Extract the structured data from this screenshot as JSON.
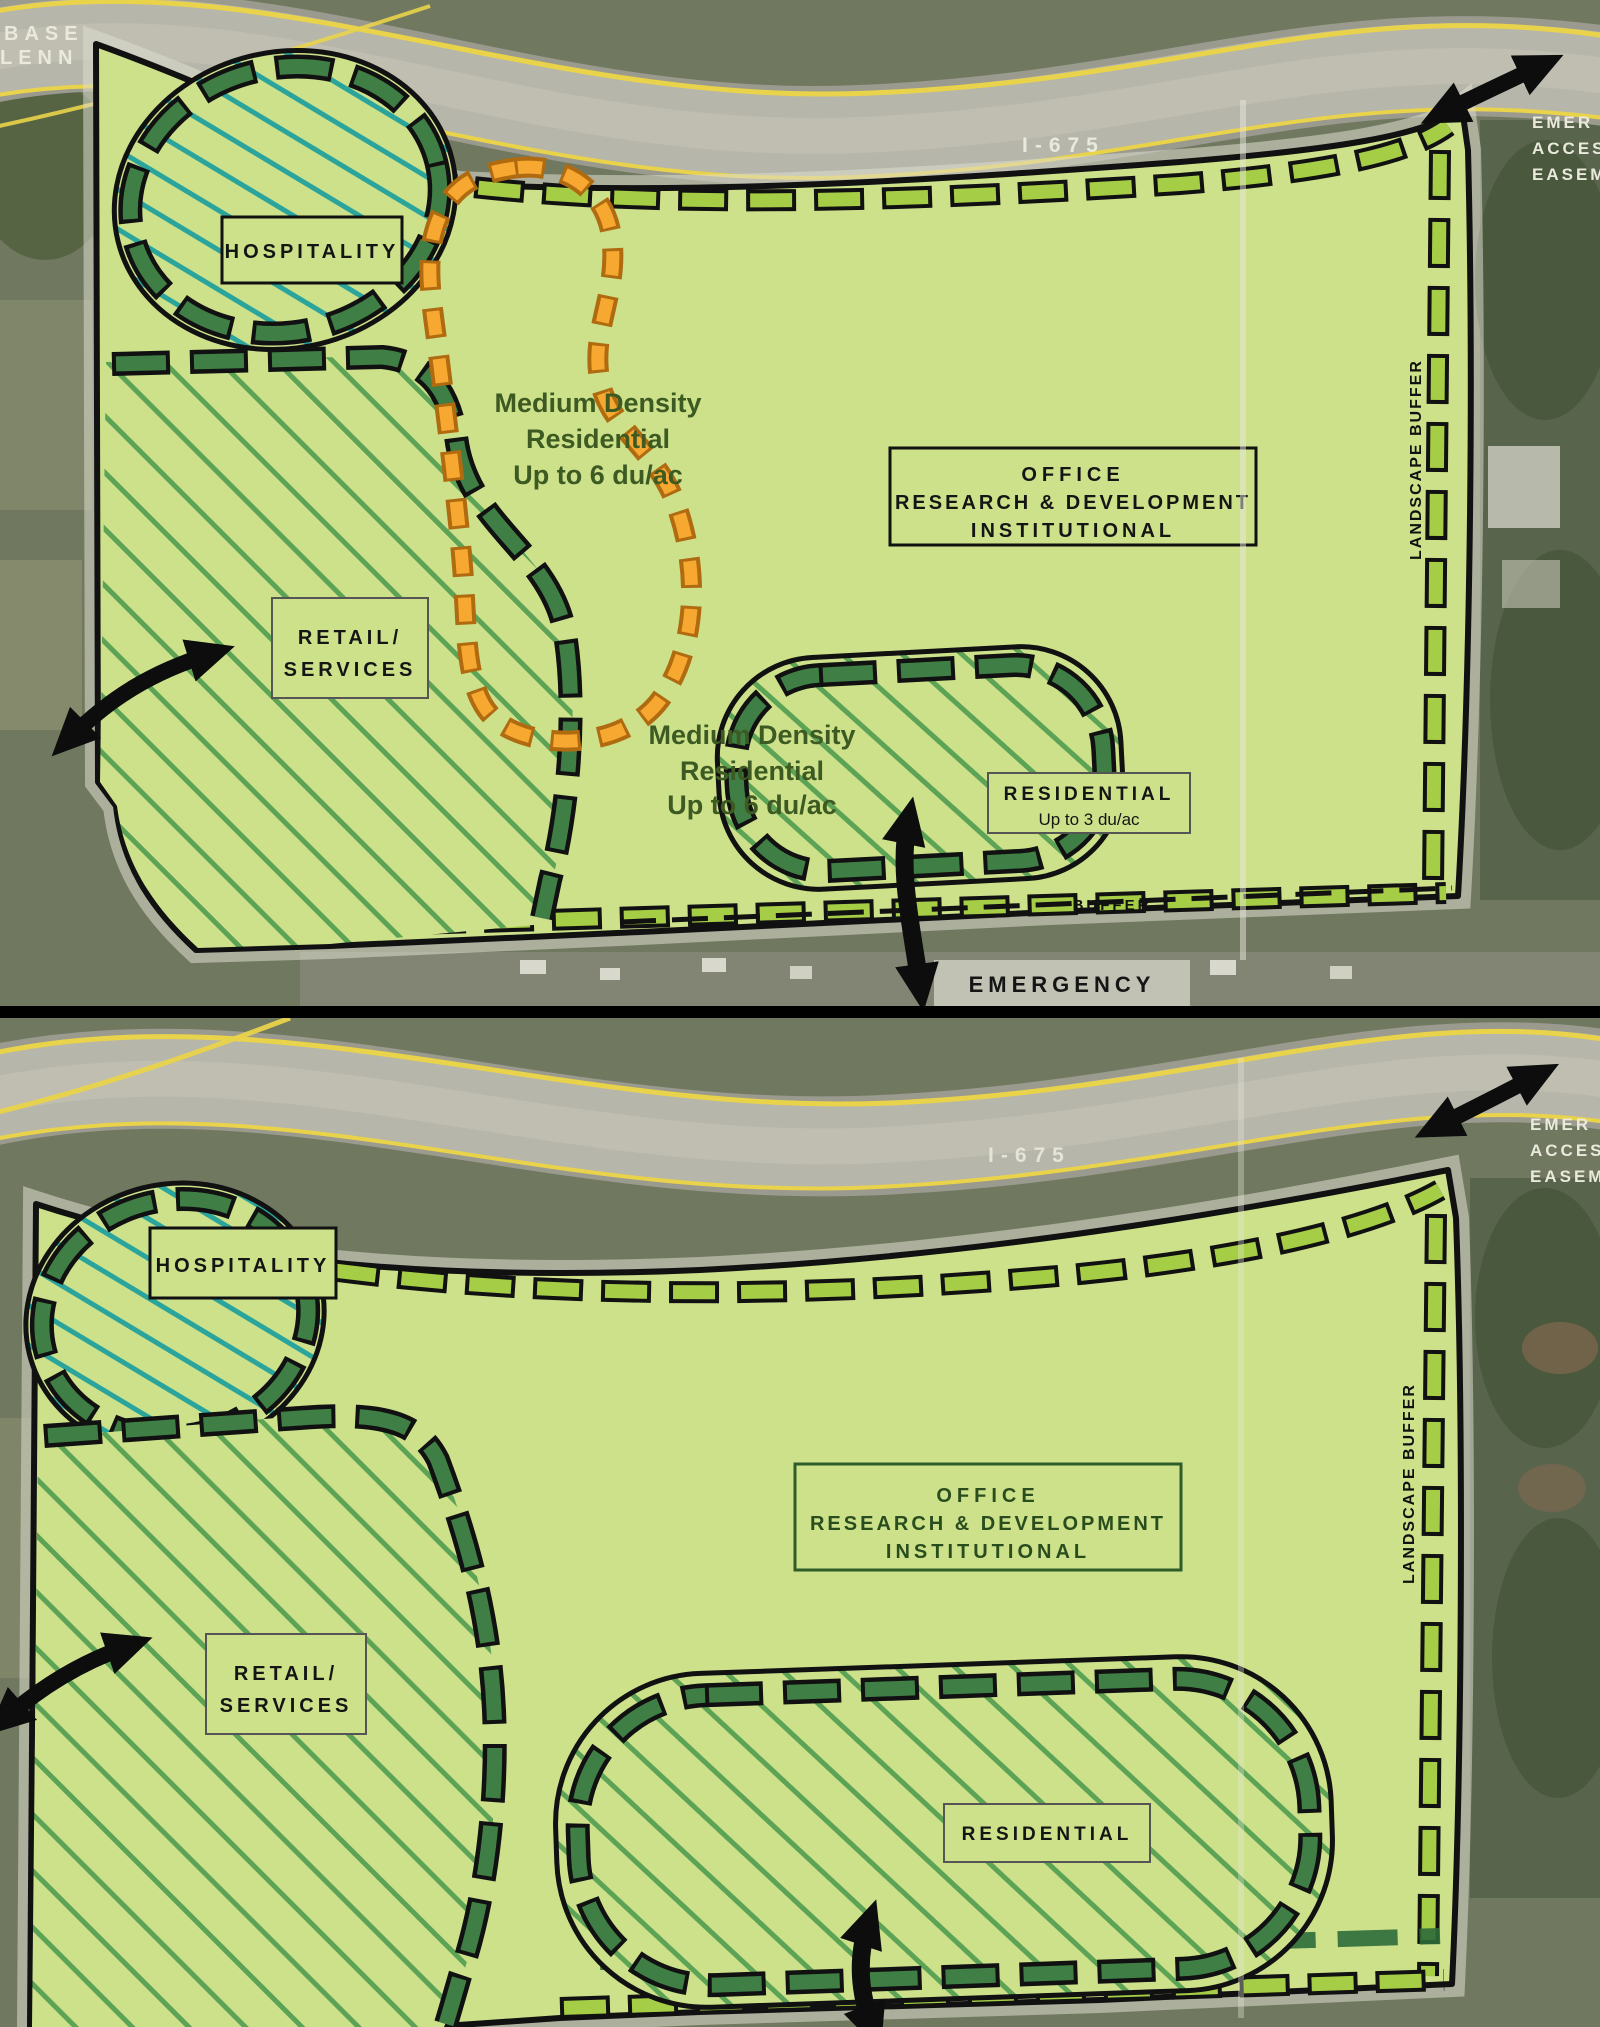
{
  "document": {
    "type": "land-use concept plan scan, two stacked aerial site plans",
    "divider_color": "#000000"
  },
  "colors": {
    "aerial_ground": "#70795f",
    "aerial_trees": "#51603f",
    "highway_pavement": "#b7b6aa",
    "lane_marking_yellow": "#e9d34a",
    "site_fill": "#cde18b",
    "perimeter_buffer_green": "#a5cd45",
    "zone_ring_dark_green": "#3f7f46",
    "hatch_green": "#5da355",
    "hatch_teal": "#2ba59c",
    "orange_road": "#f6a830",
    "orange_road_edge": "#b06a10",
    "outline_black": "#111111",
    "white_text": "#e9e9dc"
  },
  "plans": [
    {
      "name": "concept-plan-upper",
      "edge_left_line1": "BASE",
      "edge_left_line2": "LENN",
      "highway_label": "I-675",
      "easement_lines": [
        "EMER",
        "ACCES",
        "EASEM"
      ],
      "hospitality_label": "HOSPITALITY",
      "retail_lines": [
        "RETAIL/",
        "SERVICES"
      ],
      "office_lines": [
        "OFFICE",
        "RESEARCH & DEVELOPMENT",
        "INSTITUTIONAL"
      ],
      "medium_density_upper_lines": [
        "Medium Density",
        "Residential",
        "Up to 6 du/ac"
      ],
      "medium_density_lower_lines": [
        "Medium Density",
        "Residential",
        "Up to 6 du/ac"
      ],
      "residential_label": "RESIDENTIAL",
      "residential_sublabel": "Up to 3 du/ac",
      "landscape_buffer_vertical": "LANDSCAPE BUFFER",
      "buffer_bottom_label": "BUFFER",
      "emergency_line1": "EMERGENCY",
      "emergency_line2": "ACCESS"
    },
    {
      "name": "concept-plan-lower",
      "highway_label": "I-675",
      "easement_lines": [
        "EMER",
        "ACCES",
        "EASEM"
      ],
      "hospitality_label": "HOSPITALITY",
      "retail_lines": [
        "RETAIL/",
        "SERVICES"
      ],
      "office_lines": [
        "OFFICE",
        "RESEARCH & DEVELOPMENT",
        "INSTITUTIONAL"
      ],
      "residential_label": "RESIDENTIAL",
      "landscape_buffer_vertical": "LANDSCAPE BUFFER",
      "landscape_buffer_bottom": "LANDSCAPE BUFFER"
    }
  ]
}
